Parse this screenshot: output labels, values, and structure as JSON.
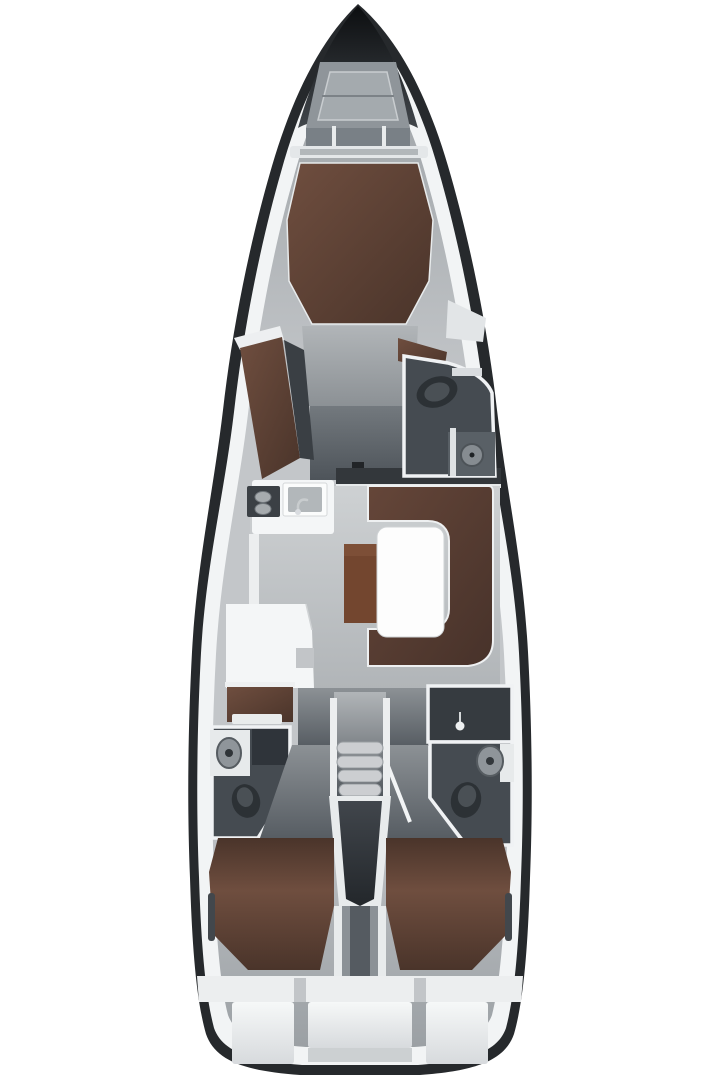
{
  "image": {
    "kind": "yacht-interior-floor-plan-top-view",
    "description": "Top-down interior layout plan of a sailing yacht: bow anchor locker, forward owner cabin with island berth and chaise, forward head with shower, saloon with galley, nav station, U-shaped sofa and table, companionway stairs, two aft heads, twin aft double cabins and stern lockers"
  },
  "regions": [
    {
      "name": "anchor-locker"
    },
    {
      "name": "forward-cabin"
    },
    {
      "name": "forward-head"
    },
    {
      "name": "saloon"
    },
    {
      "name": "galley"
    },
    {
      "name": "nav-station"
    },
    {
      "name": "companionway-stairs"
    },
    {
      "name": "aft-head-port"
    },
    {
      "name": "aft-head-starboard"
    },
    {
      "name": "aft-cabin-port"
    },
    {
      "name": "aft-cabin-starboard"
    },
    {
      "name": "stern-lockers"
    }
  ],
  "colors": {
    "background": "#ffffff",
    "hullDark": "#26292c",
    "hullBand": "#f2f4f5",
    "deckLight": "#c3c6c9",
    "deckDark": "#9ba0a4",
    "noseBlack": "#0c0e10",
    "noseGray": "#41464b",
    "lockerGray": "#8f959a",
    "lockerInner": "#a4aaae",
    "wall": "#f0f2f4",
    "white": "#f4f6f7",
    "tableWhite": "#fdfdfd",
    "floorLight": "#ced1d3",
    "floorDark": "#b1b5b8",
    "corridorLight": "#8c9195",
    "corridorDark": "#575d63",
    "storageLight": "#73797e",
    "storageDark": "#4e545a",
    "headRoom": "#454b51",
    "headDarker": "#363b40",
    "fixtureDark": "#2c3135",
    "fixtureMid": "#4a5055",
    "fixtureGray": "#8f959a",
    "bedLight": "#6f4e3f",
    "bedDark": "#4a342a",
    "sofaLight": "#654639",
    "sofaDark": "#47322a",
    "bench": "#73462f",
    "benchCap": "#7d4f37",
    "stepTread": "#ccced1",
    "pentTop": "#41464c",
    "pentBottom": "#23272b",
    "channelGray": "#8b9196",
    "channelDark": "#555b61",
    "sternWhite": "#f6f8f8",
    "sternShade": "#d7dadd",
    "shelfGray": "#ccd0d2",
    "gapGray": "#c2c5c8",
    "slitDark": "#42474c",
    "darkSquare": "#212427",
    "bulkhead": "#33373b",
    "stove": "#3b4045",
    "sinkInner": "#b2b7ba",
    "cabinetDark": "#2f343a"
  }
}
